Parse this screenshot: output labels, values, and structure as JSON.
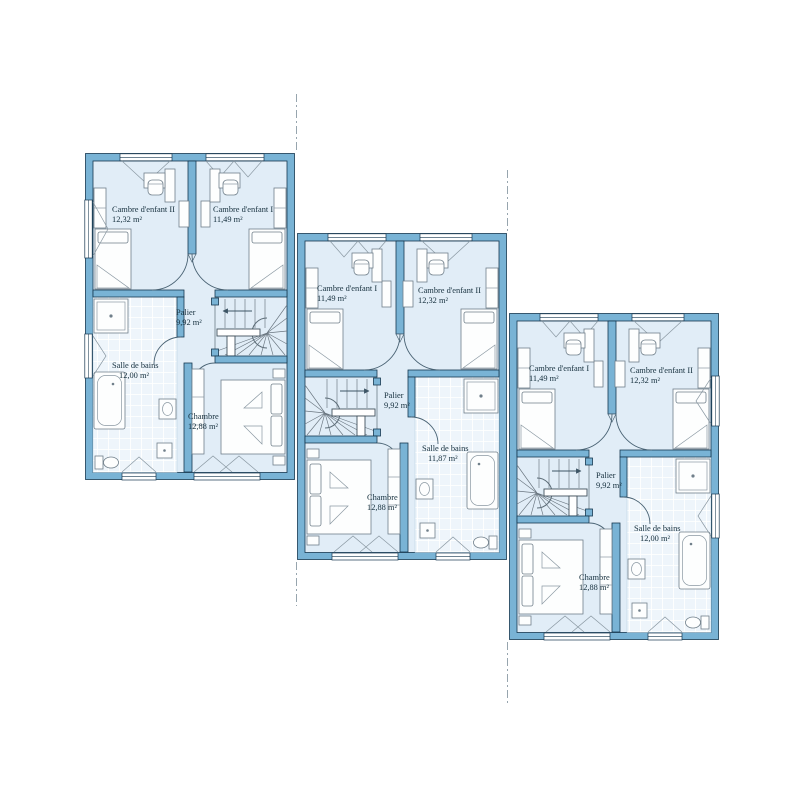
{
  "document": {
    "kind": "floor-plan",
    "background": "#ffffff",
    "units_count": 3
  },
  "palette": {
    "wall_fill": "#79b3d5",
    "wall_stroke": "#16374f",
    "floor_fill": "#e1edf7",
    "tile_fill": "#eef5fb",
    "tile_grout": "#ffffff",
    "furniture_stroke": "#707f8a",
    "door_arc": "#4a6374",
    "boundary_dash": "#97a5ae",
    "label_color": "#152f3d"
  },
  "units": [
    {
      "id": "unit-1",
      "rooms": {
        "child_left": {
          "name": "Cambre d'enfant II",
          "area": "12,32 m²"
        },
        "child_right": {
          "name": "Cambre d'enfant I",
          "area": "11,49 m²"
        },
        "palier": {
          "name": "Palier",
          "area": "9,92 m²"
        },
        "bath": {
          "name": "Salle de bains",
          "area": "12,00 m²"
        },
        "chambre": {
          "name": "Chambre",
          "area": "12,88 m²"
        }
      }
    },
    {
      "id": "unit-2",
      "rooms": {
        "child_left": {
          "name": "Cambre d'enfant I",
          "area": "11,49 m²"
        },
        "child_right": {
          "name": "Cambre d'enfant II",
          "area": "12,32 m²"
        },
        "palier": {
          "name": "Palier",
          "area": "9,92 m²"
        },
        "bath": {
          "name": "Salle de bains",
          "area": "11,87 m²"
        },
        "chambre": {
          "name": "Chambre",
          "area": "12,88 m²"
        }
      }
    },
    {
      "id": "unit-3",
      "rooms": {
        "child_left": {
          "name": "Cambre d'enfant I",
          "area": "11,49 m²"
        },
        "child_right": {
          "name": "Cambre d'enfant II",
          "area": "12,32 m²"
        },
        "palier": {
          "name": "Palier",
          "area": "9,92 m²"
        },
        "bath": {
          "name": "Salle de bains",
          "area": "12,00 m²"
        },
        "chambre": {
          "name": "Chambre",
          "area": "12,88 m²"
        }
      }
    }
  ]
}
